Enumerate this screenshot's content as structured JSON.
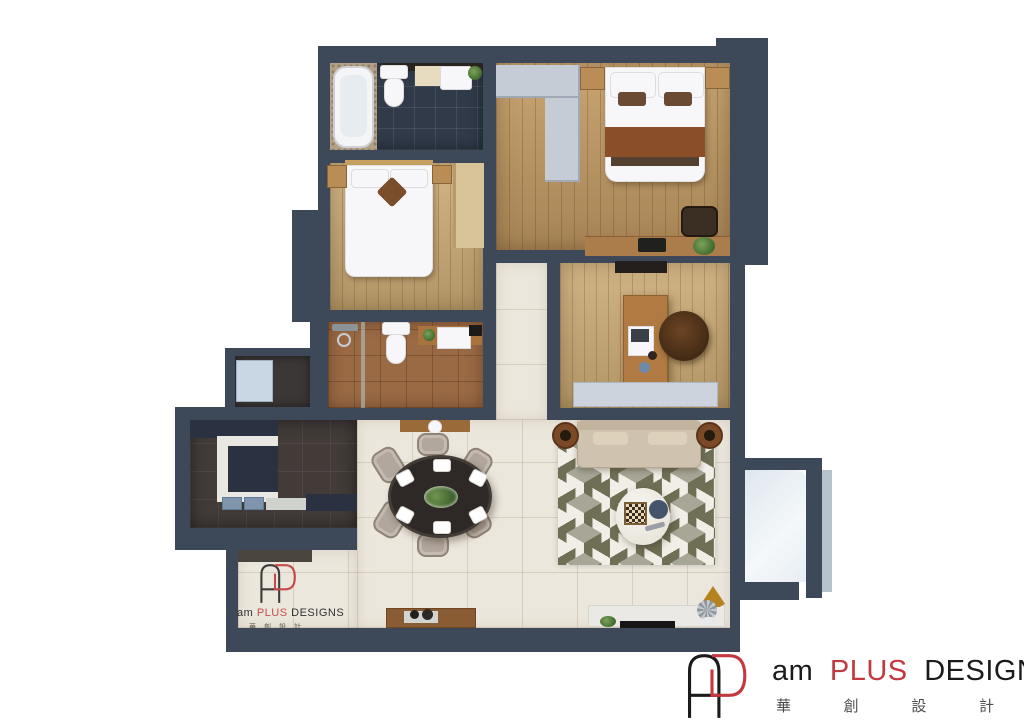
{
  "brand": {
    "word_am": "am",
    "word_plus": "PLUS",
    "word_designs": "DESIGNS",
    "chinese": [
      "華",
      "創",
      "設",
      "計"
    ]
  },
  "palette": {
    "wall": "#3d4858",
    "wall_light": "#b8c2cc",
    "floor_cream": "#ece7dd",
    "floor_wood": "#c29a63",
    "floor_wood_light": "#cbaa74",
    "bath1_tile": "#303a49",
    "bath2_tile": "#9a6a45",
    "kitchen_tile": "#423b38",
    "rug_olive": "#6f6f56",
    "rug_gray": "#a7a697",
    "rug_white": "#f1eee7",
    "sofa": "#cfc2ae",
    "blanket_rust": "#8a4f28",
    "counter_navy": "#2a3140",
    "sink_blue": "#7e95ad",
    "accent_red": "#c23a3f",
    "ink": "#1b1b1b"
  }
}
